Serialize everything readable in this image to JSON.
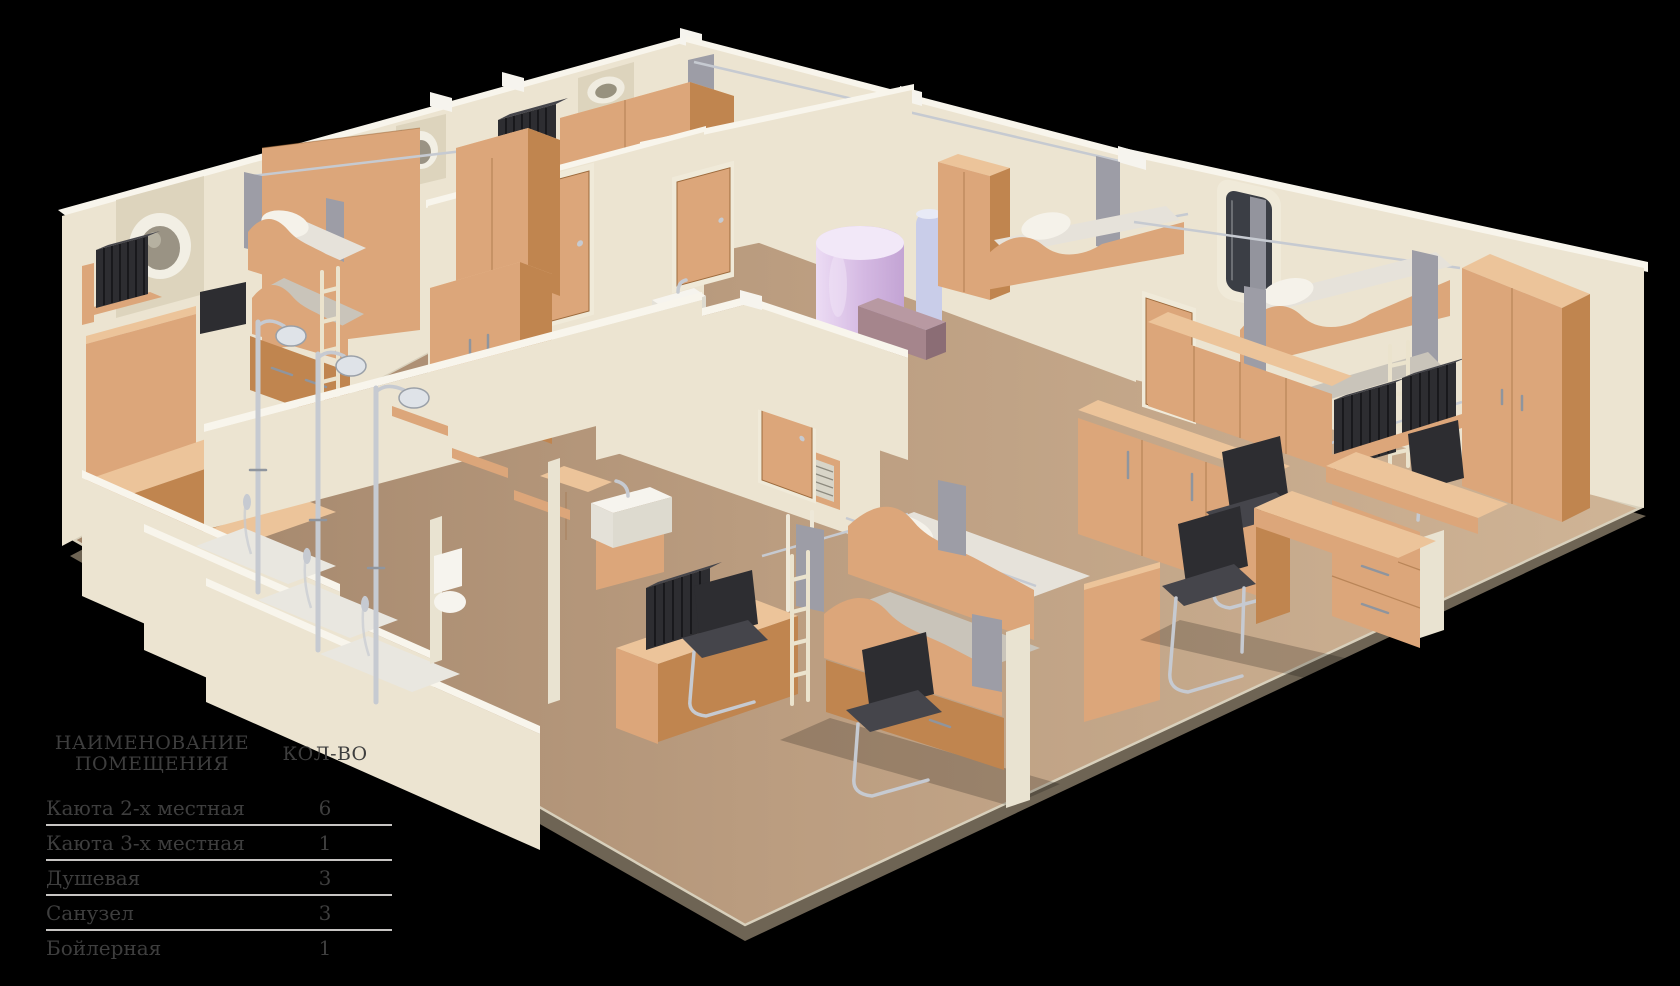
{
  "palette": {
    "bg": "#000000",
    "wall": "#ece4d1",
    "wall_shade": "#ddd4bd",
    "wall_top": "#f8f5ec",
    "wood": "#dca67a",
    "wood_dark": "#c0854f",
    "wood_top": "#ecc49a",
    "wood_deep": "#9c6a3c",
    "floor": "#b7997d",
    "floor_light": "#cbb092",
    "rim": "#6e6454",
    "rim_light": "#d8d0bc",
    "bedding": "#e6e2da",
    "bedding_shade": "#c9c4ba",
    "pillow": "#f5f2ea",
    "curtain": "#9d9da6",
    "chrome": "#c6cad1",
    "chrome_dark": "#8f959e",
    "black_item": "#2d2d31",
    "black_item_light": "#45454b",
    "boiler": "#d9c2e4",
    "boiler_light": "#f2e8f8",
    "pipe": "#c9cde9",
    "mauve": "#a5858c",
    "glass": "#3b3e45",
    "tray": "#e9e7e0",
    "table_text": "#3e3e3e",
    "table_line": "#c7c5c3"
  },
  "legend_table": {
    "header": {
      "name_line1": "НАИМЕНОВАНИЕ",
      "name_line2": "ПОМЕЩЕНИЯ",
      "qty": "КОЛ-ВО"
    },
    "rows": [
      {
        "name": "Каюта 2-х местная",
        "qty": "6"
      },
      {
        "name": "Каюта 3-х местная",
        "qty": "1"
      },
      {
        "name": "Душевая",
        "qty": "3"
      },
      {
        "name": "Санузел",
        "qty": "3"
      },
      {
        "name": "Бойлерная",
        "qty": "1"
      }
    ]
  }
}
